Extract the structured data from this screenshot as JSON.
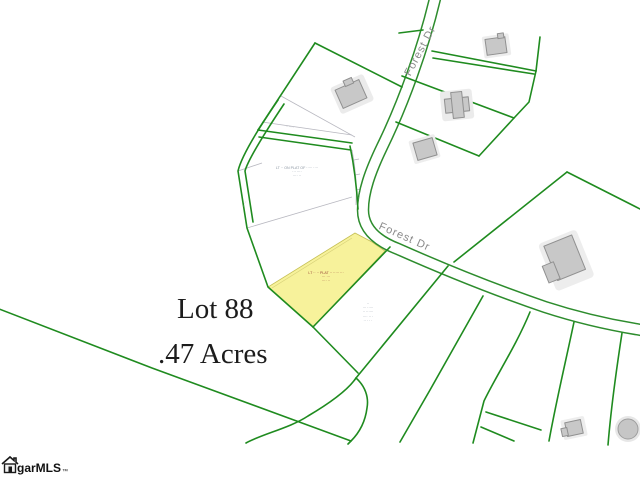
{
  "map": {
    "title": {
      "lot": "Lot 88",
      "acreage": ".47 Acres"
    },
    "roads": [
      {
        "name": "Forest Dr"
      },
      {
        "name": "Forest Dr"
      }
    ],
    "watermark": {
      "name": "garMLS",
      "tm": "™"
    },
    "highlighted_lot": {
      "label": "Lot 88",
      "acres": ".47"
    },
    "colors": {
      "parcel_line": "#1f8b1f",
      "road_edge": "#2d8c2d",
      "plat_line": "#b8b8c0",
      "house_fill": "#c8c8c8",
      "highlight_fill": "#f7f29b",
      "label_gray": "#8a8a8a",
      "title_color": "#1c1c1c"
    },
    "annotations": {
      "plat_center": [
        "LT ·· ON PLAT OF ····· ····",
        "··· ····",
        "···· ··"
      ],
      "highlight_center": [
        "LT ·· ·· PLAT ·· ····· ···",
        "··· ···",
        "···· ··"
      ],
      "south_lot": [
        "··",
        "··· ·····",
        "·· ······",
        "···· ·· ·",
        "·· · · ·"
      ],
      "bearing_1": "··· ··· ·",
      "bearing_2": "·· ····",
      "bearing_3": "·· ···"
    }
  }
}
